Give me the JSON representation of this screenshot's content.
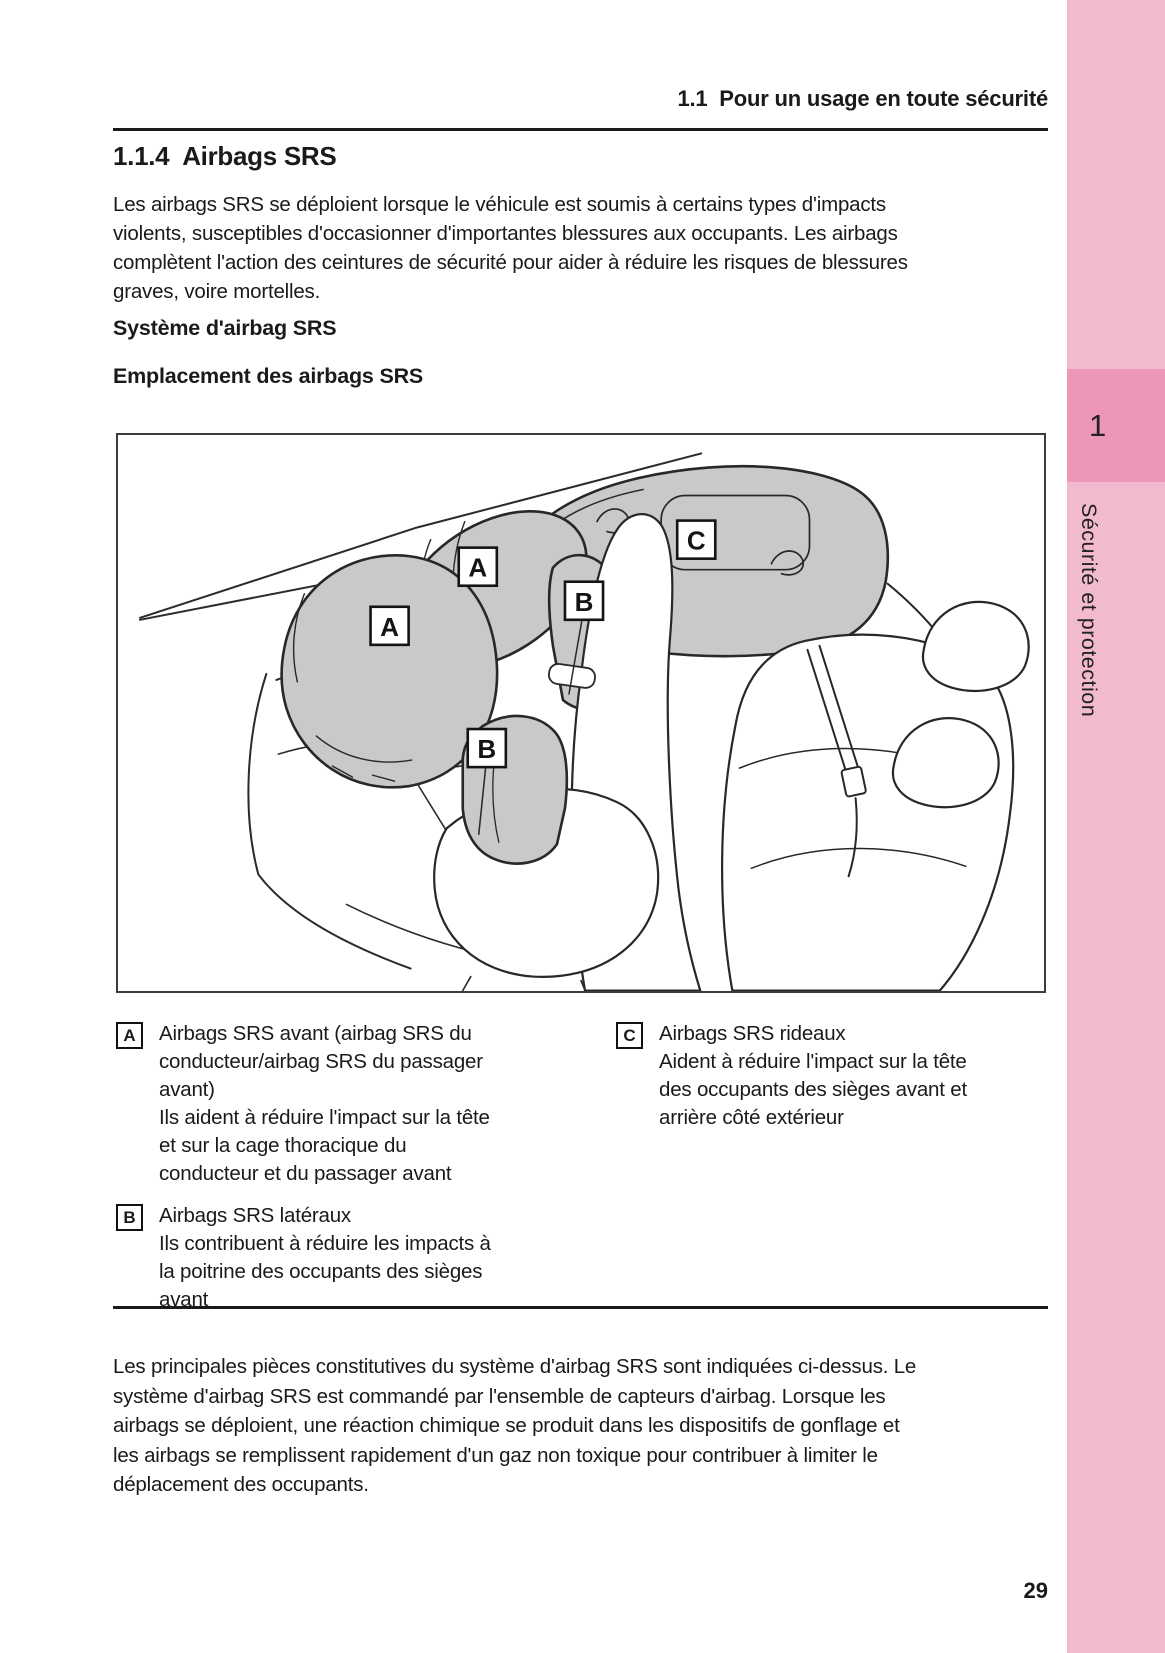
{
  "page": {
    "header": {
      "title": "1.1  Pour un usage en toute sécurité"
    },
    "section_title": "1.1.4  Airbags SRS",
    "intro": "Les airbags SRS se déploient lorsque le véhicule est soumis à certains types d'impacts\nviolents, susceptibles d'occasionner d'importantes blessures aux occupants. Les airbags\ncomplètent l'action des ceintures de sécurité pour aider à réduire les risques de blessures\ngraves, voire mortelles.",
    "subhead_system": "Système d'airbag SRS",
    "subhead_location": "Emplacement des airbags SRS",
    "figure": {
      "labels": {
        "front_driver": "A",
        "front_passenger": "A",
        "side_upper": "B",
        "side_lower": "B",
        "curtain": "C"
      }
    },
    "legend": {
      "items": [
        {
          "marker": "A",
          "text": "Airbags SRS avant (airbag SRS du\nconducteur/airbag SRS du passager\navant)\nIls aident à réduire l'impact sur la tête\net sur la cage thoracique du\nconducteur et du passager avant"
        },
        {
          "marker": "B",
          "text": "Airbags SRS latéraux\nIls contribuent à réduire les impacts à\nla poitrine des occupants des sièges\navant"
        },
        {
          "marker": "C",
          "text": "Airbags SRS rideaux\nAident à réduire l'impact sur la tête\ndes occupants des sièges avant et\narrière côté extérieur"
        }
      ]
    },
    "outro": "Les principales pièces constitutives du système d'airbag SRS sont indiquées ci-dessus. Le\nsystème d'airbag SRS est commandé par l'ensemble de capteurs d'airbag. Lorsque les\nairbags se déploient, une réaction chimique se produit dans les dispositifs de gonflage et\nles airbags se remplissent rapidement d'un gaz non toxique pour contribuer à limiter le\ndéplacement des occupants.",
    "page_number": "29",
    "sidebar": {
      "chapter_number": "1",
      "chapter_label": "Sécurité et protection"
    },
    "colors": {
      "sidebar_light": "#F2BACE",
      "sidebar_dark": "#EE96B8",
      "airbag_gray": "#C9C9C9",
      "rule_black": "#1A1A1A"
    }
  }
}
